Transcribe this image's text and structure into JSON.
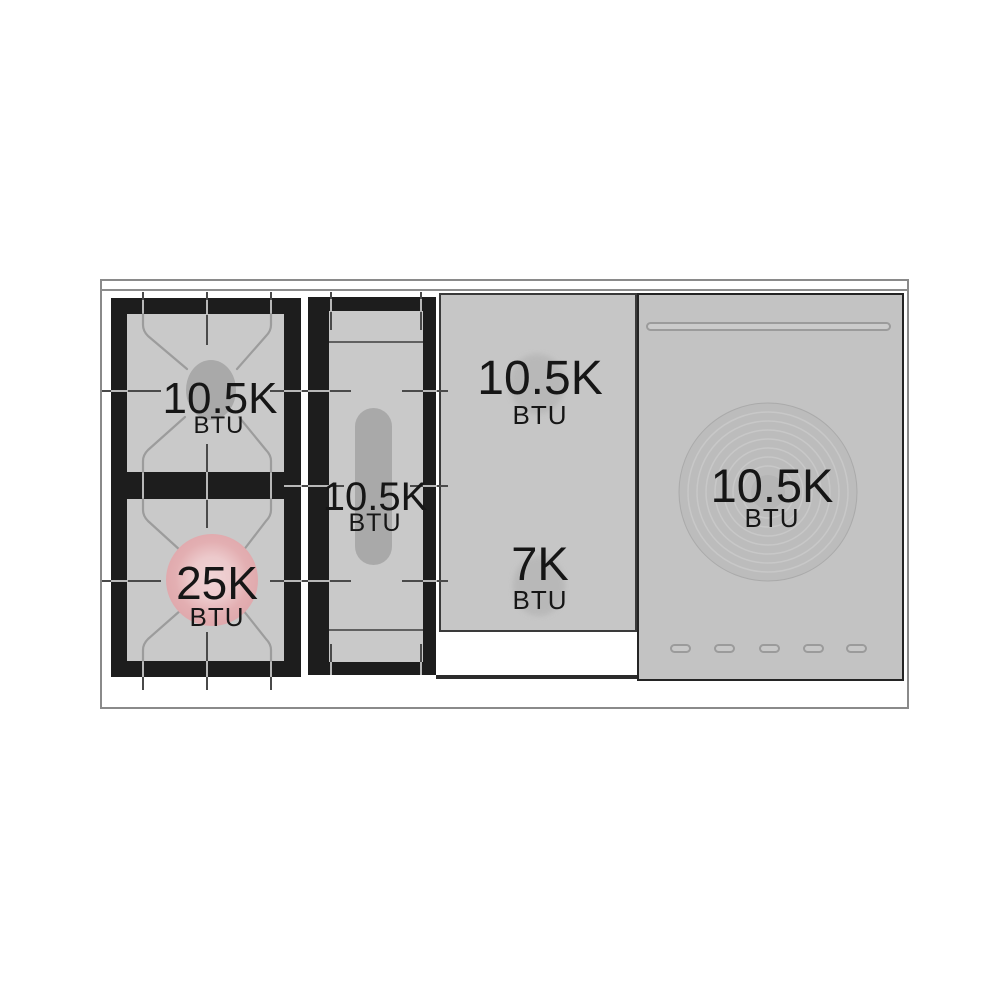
{
  "cooktop": {
    "gas_burner_section": {
      "top_burner": {
        "value": "10.5K",
        "unit": "BTU"
      },
      "bottom_burner": {
        "value": "25K",
        "unit": "BTU"
      }
    },
    "griddle_section": {
      "burner": {
        "value": "10.5K",
        "unit": "BTU"
      }
    },
    "middle_section": {
      "top_burner": {
        "value": "10.5K",
        "unit": "BTU"
      },
      "bottom_burner": {
        "value": "7K",
        "unit": "BTU"
      }
    },
    "french_top_section": {
      "burner": {
        "value": "10.5K",
        "unit": "BTU"
      }
    },
    "colors": {
      "grate_black": "#1d1d1d",
      "surface_gray": "#c9c9c9",
      "panel_gray": "#c3c3c3",
      "burner_cap_gray": "#a9a9a9",
      "burner_cap_highlight_pink": "#e3afb2",
      "label_text": "#161616"
    }
  }
}
